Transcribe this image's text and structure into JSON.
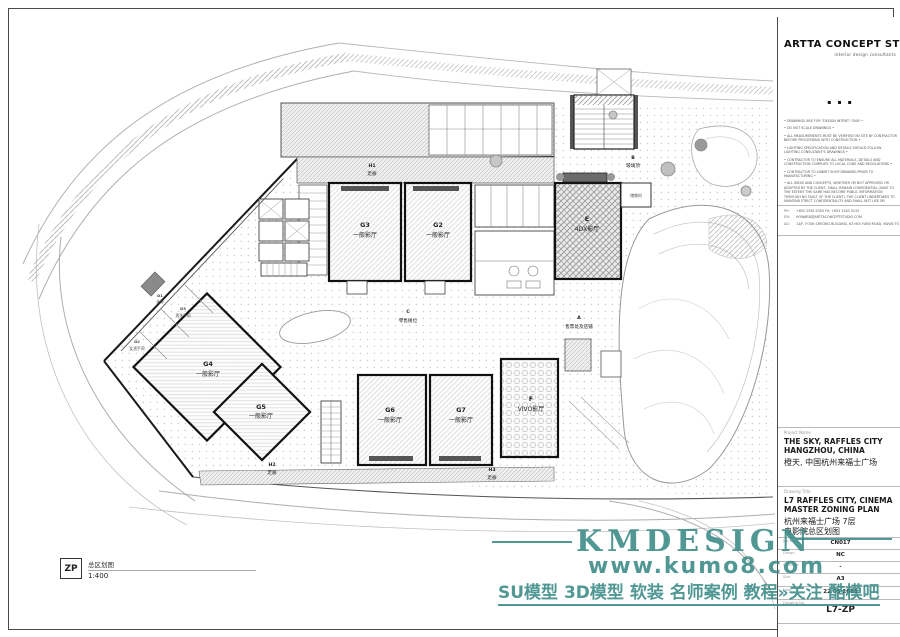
{
  "titleblock": {
    "logo": {
      "name": "ARTTA CONCEPT STUDIO",
      "tagline": "interior design consultants",
      "separator": "▪ ▪ ▪"
    },
    "notes": [
      "• DRAWINGS ARE FOR \"DESIGN INTENT\" ONLY •",
      "• DO NOT SCALE DRAWINGS •",
      "• ALL MEASUREMENTS MUST BE VERIFIED ON SITE BY CONTRACTOR BEFORE PROCEEDING WITH CONSTRUCTION •",
      "• LIGHTING SPECIFICATION AND DETAILS SHOULD FOLLOW LIGHTING CONSULTANT'S DRAWINGS •",
      "• CONTRACTOR TO ENSURE ALL MATERIALS, DETAILS AND CONSTRUCTION COMPLIES TO LOCAL CODE AND REGULATIONS •",
      "• CONTRACTOR TO SUBMIT SHOP DRAWING PRIOR TO MANUFACTURING •",
      "• ALL IDEAS AND CONCEPTS, WHETHER OR NOT APPROVED OR ADOPTED BY THE CLIENT, SHALL REMAIN CONFIDENTIAL (SAVE TO THE EXTENT THE SAME HAS BECOME PUBLIC INFORMATION THROUGH NO FAULT OF THE CLIENT). THE CLIENT UNDERTAKES TO MAINTAIN STRICT CONFIDENTIALITY AND SHALL NOT USE OR DIVULGE SUCH CONFIDENTIAL INFORMATION TO ANY THIRD PARTY WITHOUT PRIOR WRITTEN CONSENT FROM ARTTA CONCEPT STUDIO LTD •",
      "• READ THIS DRAWING IN CONNECTION WITH GENERAL ARCHITECTURAL PLANS, STRUCTURAL PLANS, AND OTHER RELATED DRAWINGS •"
    ],
    "contact": {
      "ph_label": "PH:",
      "ph": "+852 2530 5355    FX: +852 2503 5133",
      "em_label": "EM:",
      "em": "HOWARD@ARTTACONCEPTSTUDIO.COM",
      "ad_label": "AD:",
      "ad": "14/F, FOOK CHEONG BUILDING, 63 HOI YUEN ROAD, KWUN TONG"
    },
    "project": {
      "label": "Project Name",
      "en1": "THE SKY, RAFFLES CITY",
      "en2": "HANGZHOU, CHINA",
      "cn": "橙天, 中国杭州来福士广场"
    },
    "drawing": {
      "label": "Drawing Title",
      "en1": "L7 RAFFLES CITY, CINEMA",
      "en2": "MASTER ZONING PLAN",
      "cn1": "杭州来福士广场 7层",
      "cn2": "电影院总区划图"
    },
    "fields": {
      "job_label": "Job No.",
      "job": "CN017",
      "drawn_label": "Drawn",
      "drawn": "NC",
      "checked_label": "Checked",
      "checked": "-",
      "size_label": "Size",
      "size": "A3",
      "date_label": "Date",
      "date": "22 05 2018",
      "dwgno_label": "Drawing No.",
      "dwgno": "L7-ZP"
    }
  },
  "plan": {
    "zones": {
      "h1": {
        "letter": "H1",
        "name": "走廊"
      },
      "g3": {
        "letter": "G3",
        "name": "一般影厅"
      },
      "g2": {
        "letter": "G2",
        "name": "一般影厅"
      },
      "e": {
        "letter": "E",
        "name": "4DX影厅"
      },
      "b": {
        "letter": "B",
        "name": "玻璃顶"
      },
      "store": {
        "letter": "",
        "name": "储物间"
      },
      "a": {
        "letter": "A",
        "name": "售票处及店铺"
      },
      "c": {
        "letter": "C",
        "name": "零售摊位"
      },
      "d1": {
        "letter": "D1",
        "name": "走廊"
      },
      "d3": {
        "letter": "D3",
        "name": "男洗手间"
      },
      "d2": {
        "letter": "D2",
        "name": "女洗手间"
      },
      "g4": {
        "letter": "G4",
        "name": "一般影厅"
      },
      "g5": {
        "letter": "G5",
        "name": "一般影厅"
      },
      "g6": {
        "letter": "G6",
        "name": "一般影厅"
      },
      "g7": {
        "letter": "G7",
        "name": "一般影厅"
      },
      "f": {
        "letter": "F",
        "name": "VIVO影厅"
      },
      "h3": {
        "letter": "H3",
        "name": "走廊"
      },
      "h2": {
        "letter": "H2",
        "name": "走廊"
      }
    }
  },
  "legend": {
    "code": "ZP",
    "name": "总区划图",
    "scale": "1:400"
  },
  "watermark": {
    "brand": "KMDESIGN",
    "url": "www.kumo8.com",
    "tagline": "SU模型 3D模型 软装 名师案例 教程»关注 酷模吧",
    "color": "#3f8d8a"
  }
}
